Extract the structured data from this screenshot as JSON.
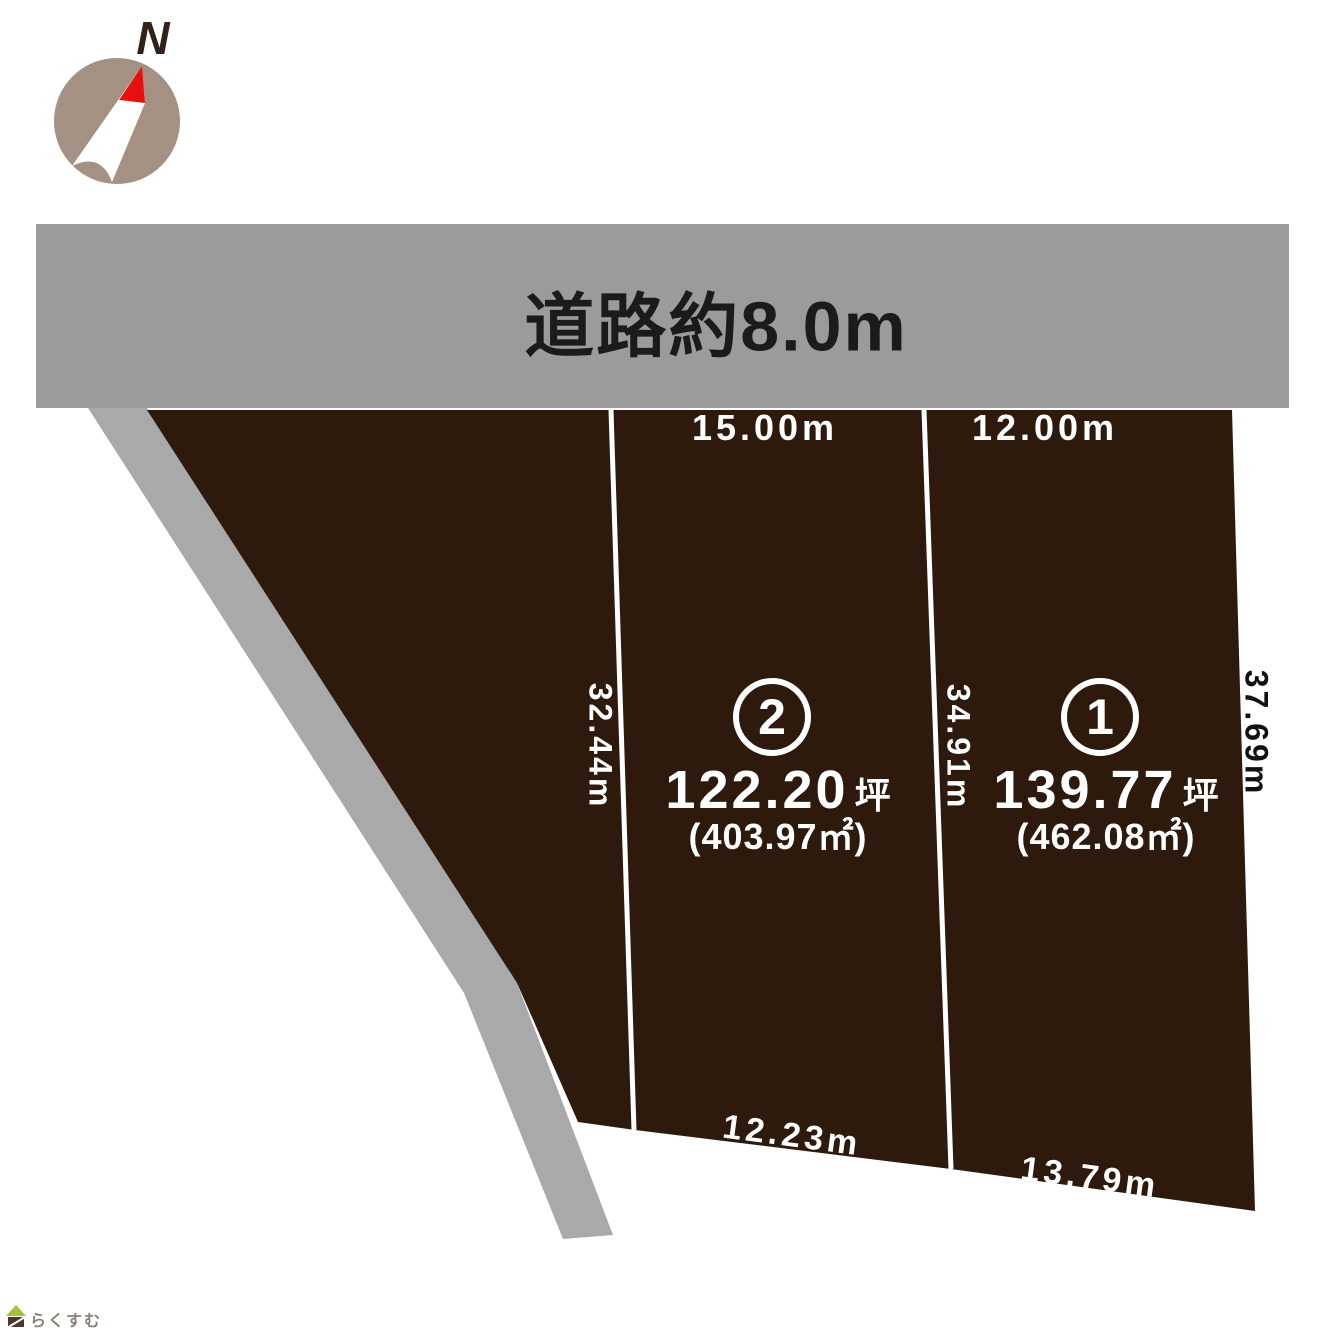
{
  "compass": {
    "north_label": "N"
  },
  "road": {
    "label": "道路約8.0m"
  },
  "dimensions": {
    "plot2_frontage": "15.00m",
    "plot1_frontage": "12.00m",
    "side_west": "32.44m",
    "side_middle": "34.91m",
    "side_east": "37.69m",
    "plot2_rear": "12.23m",
    "plot1_rear": "13.79m"
  },
  "plot2": {
    "number": "2",
    "tsubo_value": "122.20",
    "tsubo_unit": "坪",
    "area_sqm": "(403.97㎡)"
  },
  "plot1": {
    "number": "1",
    "tsubo_value": "139.77",
    "tsubo_unit": "坪",
    "area_sqm": "(462.08㎡)"
  },
  "watermark": {
    "text": "らくすむ"
  },
  "colors": {
    "plot_fill": "#2e1a0d",
    "road_fill": "#9b9b9b",
    "path_fill": "#a9a9a9",
    "divider": "#ffffff",
    "compass_circle": "#a59184",
    "compass_needle": "#ffffff",
    "compass_tip": "#e8100c",
    "logo_roof": "#a6bf3c",
    "logo_body": "#4a392b"
  }
}
